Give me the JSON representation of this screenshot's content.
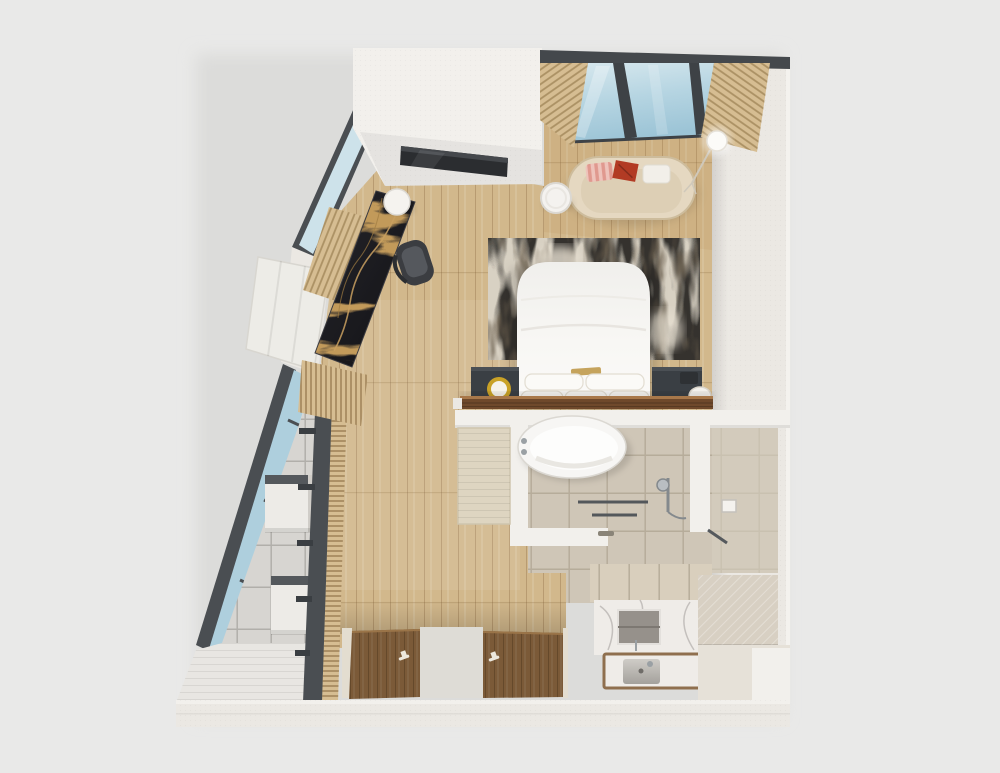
{
  "scene": {
    "type": "3d-floor-plan-render",
    "description": "Top-down 3D render of a studio hotel suite: lounge under skylight, bedroom, bathroom, slanted glass wall with terrace",
    "objects": {
      "sofa": "curved cream sofa",
      "sofa_pillows": "striped pink, rust and white cushions",
      "floor_lamp": "tripod floor lamp",
      "side_table": "round white side table",
      "bed": "double bed with white duvet",
      "rug": "abstract charcoal area rug",
      "nightstands": "two charcoal nightstands with lamps",
      "console": "walnut headboard console",
      "tv_unit": "white volume with wall TV",
      "desk": "black marble desk",
      "desk_chair": "dark desk chair",
      "desk_stool": "white cylinder stool",
      "bench": "linen bench block",
      "skylight": "sloped glazed skylight",
      "slat_walls": "wood slat accent panels",
      "terrace": "tiled terrace behind glazed partition",
      "cabinets": "two wall cabinets on terrace",
      "bathtub": "freestanding oval bathtub",
      "shower": "walk-in shower with hand shower and towel bars",
      "vanity": "marble vanity with niche and rectangular sink",
      "doors": "two walnut entry doors with handles"
    }
  },
  "palette": {
    "background": "#e9e9e8",
    "plan_shadow": "#dcdcda",
    "wall_white": "#ebe8e3",
    "wall_bright": "#f2f0ec",
    "wall_dark": "#44484c",
    "frame_dark": "#4a4e52",
    "wood_floor": "#d2b88c",
    "wood_warm": "#bd8f57",
    "glass_blue": "#aecfdd",
    "glass_pale": "#cde2ea",
    "slat_wood": "#d6bd92",
    "rug_base": "#d8d1c3",
    "rug_dark": "#34322e",
    "rug_brown": "#6b5f4e",
    "bed_white": "#f6f5f2",
    "sofa_cream": "#e5d8c1",
    "sofa_seat": "#ddcfb5",
    "pillow_pink": "#eec3bb",
    "pillow_rust": "#b23b24",
    "pillow_white": "#f2efe9",
    "nightstand_dark": "#3a3f44",
    "console_walnut": "#6f492b",
    "door_walnut": "#7b5a38",
    "marble_gold": "#c29a5a",
    "tile_bath": "#cfc6b7",
    "tile_stone": "#d7d5d1",
    "plank_white": "#e8e6e2",
    "vanity_marble": "#efece8",
    "bronze": "#8f6f4e",
    "chrome": "#9aa0a4",
    "lamp_gold": "#c9a227",
    "mat_beige": "#ded5c1",
    "tub_white": "#f7f6f4",
    "mid_strip": "#dedcd6",
    "bench_stone": "#d8d0c3",
    "step_stone": "#e6e1d8"
  }
}
